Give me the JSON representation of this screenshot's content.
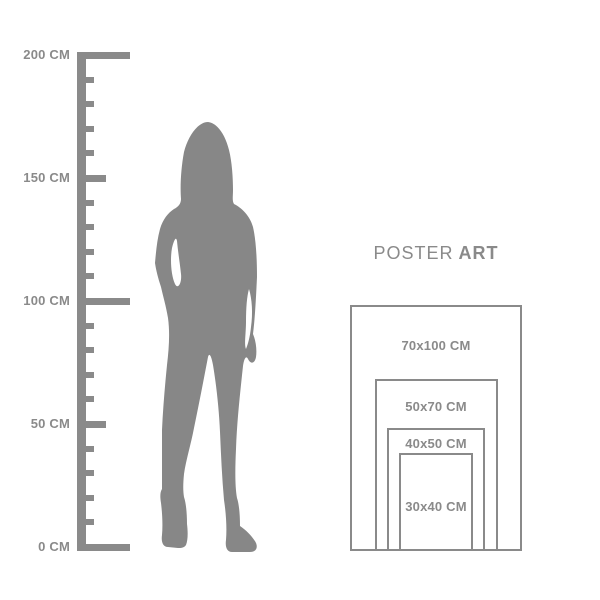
{
  "colors": {
    "background": "#ffffff",
    "figure": "#878787",
    "lines": "#8a8a8a",
    "text": "#8a8a8a"
  },
  "brand": {
    "title_regular": "POSTER",
    "title_bold": "ART"
  },
  "ruler": {
    "unit": "CM",
    "min_cm": 0,
    "max_cm": 200,
    "minor_step_cm": 10,
    "labels": [
      {
        "value_cm": 200,
        "text": "200 CM"
      },
      {
        "value_cm": 150,
        "text": "150 CM"
      },
      {
        "value_cm": 100,
        "text": "100 CM"
      },
      {
        "value_cm": 50,
        "text": "50 CM"
      },
      {
        "value_cm": 0,
        "text": "0 CM"
      }
    ]
  },
  "figure": {
    "type": "standing-woman-silhouette"
  },
  "poster_sizes": [
    {
      "label": "70x100 CM",
      "width_cm": 70,
      "height_cm": 100
    },
    {
      "label": "50x70 CM",
      "width_cm": 50,
      "height_cm": 70
    },
    {
      "label": "40x50 CM",
      "width_cm": 40,
      "height_cm": 50
    },
    {
      "label": "30x40 CM",
      "width_cm": 30,
      "height_cm": 40
    }
  ]
}
